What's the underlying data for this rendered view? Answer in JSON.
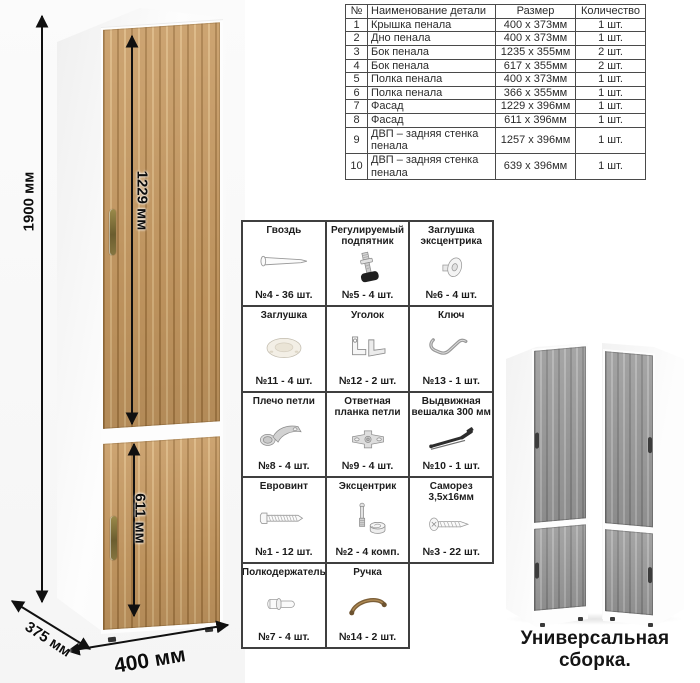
{
  "parts_table": {
    "headers": [
      "№",
      "Наименование детали",
      "Размер",
      "Количество"
    ],
    "rows": [
      {
        "num": "1",
        "name": "Крышка пенала",
        "size": "400 х 373мм",
        "qty": "1 шт."
      },
      {
        "num": "2",
        "name": "Дно пенала",
        "size": "400 х 373мм",
        "qty": "1 шт."
      },
      {
        "num": "3",
        "name": "Бок пенала",
        "size": "1235 х 355мм",
        "qty": "2 шт."
      },
      {
        "num": "4",
        "name": "Бок пенала",
        "size": "617 х 355мм",
        "qty": "2 шт."
      },
      {
        "num": "5",
        "name": "Полка пенала",
        "size": "400 х 373мм",
        "qty": "1 шт."
      },
      {
        "num": "6",
        "name": "Полка пенала",
        "size": "366 х 355мм",
        "qty": "1 шт."
      },
      {
        "num": "7",
        "name": "Фасад",
        "size": "1229 х 396мм",
        "qty": "1 шт."
      },
      {
        "num": "8",
        "name": "Фасад",
        "size": "611 х 396мм",
        "qty": "1 шт."
      },
      {
        "num": "9",
        "name": "ДВП – задняя стенка пенала",
        "size": "1257 х 396мм",
        "qty": "1 шт."
      },
      {
        "num": "10",
        "name": "ДВП – задняя стенка пенала",
        "size": "639 х 396мм",
        "qty": "1 шт."
      }
    ]
  },
  "hardware": {
    "items": [
      {
        "label": "Гвоздь",
        "qty": "№4 - 36 шт.",
        "icon": "nail-icon"
      },
      {
        "label": "Регулируемый подпятник",
        "qty": "№5 - 4 шт.",
        "icon": "adjustable-foot-icon"
      },
      {
        "label": "Заглушка эксцентрика",
        "qty": "№6 - 4 шт.",
        "icon": "cam-cover-icon"
      },
      {
        "label": "Заглушка",
        "qty": "№11 - 4 шт.",
        "icon": "plug-cap-icon"
      },
      {
        "label": "Уголок",
        "qty": "№12 - 2 шт.",
        "icon": "corner-bracket-icon"
      },
      {
        "label": "Ключ",
        "qty": "№13 - 1 шт.",
        "icon": "hex-key-icon"
      },
      {
        "label": "Плечо петли",
        "qty": "№8 - 4 шт.",
        "icon": "hinge-arm-icon"
      },
      {
        "label": "Ответная планка петли",
        "qty": "№9 - 4 шт.",
        "icon": "hinge-plate-icon"
      },
      {
        "label": "Выдвижная вешалка 300 мм",
        "qty": "№10 - 1 шт.",
        "icon": "pullout-hanger-icon"
      },
      {
        "label": "Евровинт",
        "qty": "№1 - 12 шт.",
        "icon": "euro-screw-icon"
      },
      {
        "label": "Эксцентрик",
        "qty": "№2 - 4 комп.",
        "icon": "eccentric-cam-icon"
      },
      {
        "label": "Саморез 3,5х16мм",
        "qty": "№3 - 22 шт.",
        "icon": "self-tapping-screw-icon"
      },
      {
        "label": "Полкодержатель",
        "qty": "№7 - 4 шт.",
        "icon": "shelf-pin-icon"
      },
      {
        "label": "Ручка",
        "qty": "№14 - 2 шт.",
        "icon": "handle-icon"
      }
    ]
  },
  "dimensions": {
    "height": "1900 мм",
    "upper_facade": "1229 мм",
    "lower_facade": "611 мм",
    "width": "400 мм",
    "depth": "375 мм"
  },
  "caption": {
    "text": "Универсальная сборка."
  },
  "colors": {
    "wood_base": "#c79a62",
    "wood_dark": "#a87c46",
    "wood_light": "#dab47e",
    "gray_wood": "#9b9b9b",
    "gray_wood_dark": "#828282",
    "handle_bronze": "#7c6b3a",
    "grid_border": "#3f3f3f"
  }
}
